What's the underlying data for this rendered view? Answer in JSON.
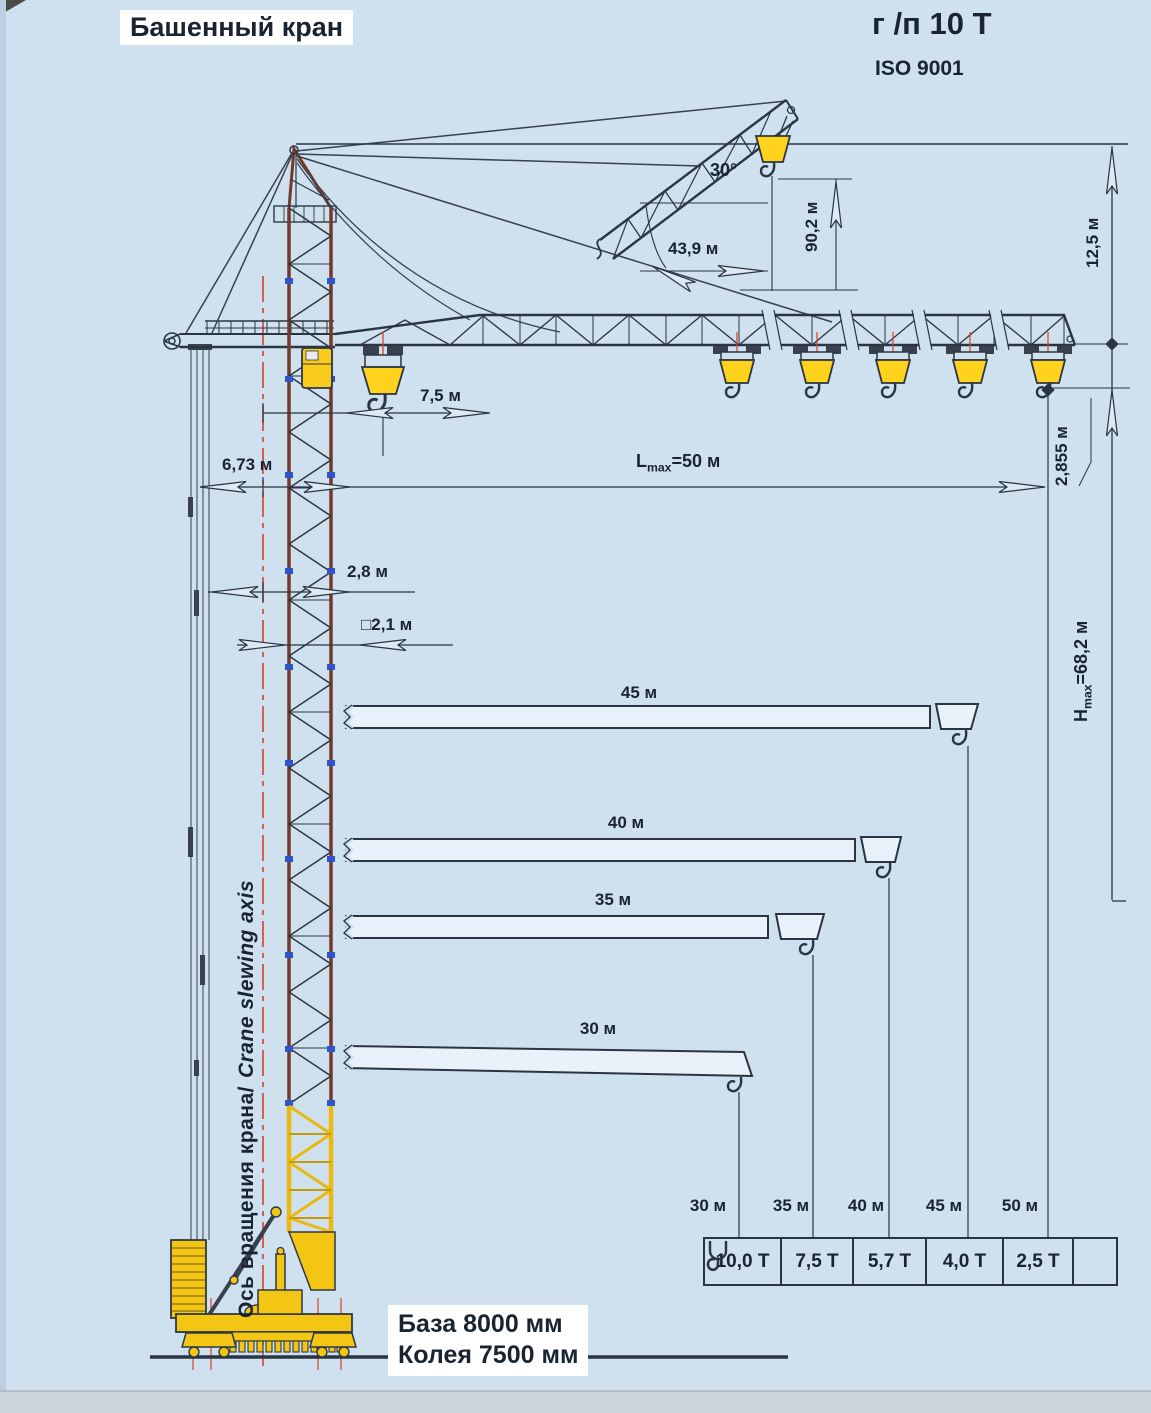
{
  "document": {
    "title": "Башенный кран",
    "capacity_note": "г /п 10 Т",
    "iso_note": "ISO 9001"
  },
  "dimensions": {
    "raised_jib_angle": "30°",
    "raised_jib_radius": "43,9 м",
    "raised_jib_hook_height": "90,2 м",
    "tower_top_offset": "12,5 м",
    "min_hook_radius": "7,5 м",
    "counterjib_radius": "6,73 м",
    "max_jib_prefix": "L",
    "max_jib_sub": "max",
    "max_jib_suffix": "=50 м",
    "hook_drop": "2,855 м",
    "axis_offset": "2,8 м",
    "tower_section": "□2,1 м",
    "max_height_prefix": "H",
    "max_height_sub": "max",
    "max_height_suffix": "=68,2 м"
  },
  "slewing_axis": {
    "label_ru": "Ось вращения крана/",
    "label_en": "Crane slewing axis"
  },
  "jib_variants": {
    "v45": "45 м",
    "v40": "40 м",
    "v35": "35 м",
    "v30": "30 м"
  },
  "load_table": {
    "radius_labels": [
      "30 м",
      "35 м",
      "40 м",
      "45 м",
      "50 м"
    ],
    "capacities": [
      "10,0 Т",
      "7,5 Т",
      "5,7 Т",
      "4,0 Т",
      "2,5 Т"
    ]
  },
  "base_labels": {
    "base": "База 8000 мм",
    "track": "Колея 7500 мм"
  },
  "icons": {
    "load_table_hook": "hook-icon"
  },
  "colors": {
    "background": "#cfe0ee",
    "line": "#2b3442",
    "yellow": "#f8cb1c",
    "red": "#d6402c",
    "tower_brown": "#74392b",
    "joint_blue": "#2f55cc"
  },
  "chart_data": {
    "type": "table",
    "title": "Грузоподъемность / load vs radius",
    "categories": [
      "30 м",
      "35 м",
      "40 м",
      "45 м",
      "50 м"
    ],
    "values": [
      10.0,
      7.5,
      5.7,
      4.0,
      2.5
    ],
    "units": {
      "category": "м",
      "value": "Т"
    }
  }
}
